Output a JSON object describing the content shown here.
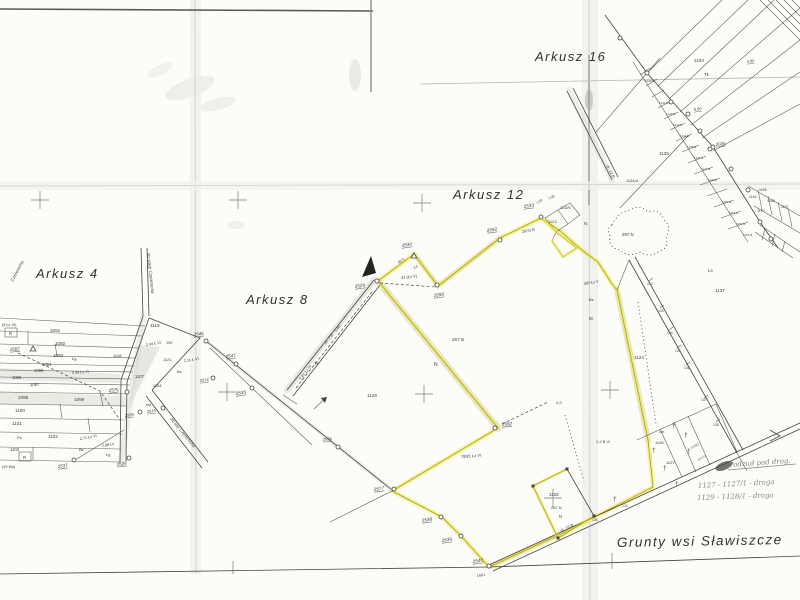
{
  "map_title": "Grunty wsi Sławiszcze",
  "colors": {
    "paper": "#fcfcf9",
    "ink": "#45453f",
    "pencil": "#87877f",
    "highlight": "#efe93e"
  },
  "handwritten_notes": {
    "heading": "Podział pod drog.",
    "line1": "1127 -  1127/1 -  droga",
    "line2": "1129 -  1128/1 -  droga"
  },
  "sheet_names": [
    "Arkusz 4",
    "Arkusz 8",
    "Arkusz 12",
    "Arkusz 16"
  ],
  "labels": [
    {
      "t": "Arkusz 4",
      "x": 36,
      "y": 278,
      "s": 13,
      "r": 0,
      "c": 1
    },
    {
      "t": "Arkusz 8",
      "x": 246,
      "y": 304,
      "s": 13,
      "r": 0,
      "c": 1
    },
    {
      "t": "Arkusz 12",
      "x": 453,
      "y": 199,
      "s": 13,
      "r": 0,
      "c": 1
    },
    {
      "t": "Arkusz 16",
      "x": 535,
      "y": 61,
      "s": 13,
      "r": 0,
      "c": 1
    },
    {
      "t": "Grunty  wsi  Sławiszcze",
      "x": 617,
      "y": 547,
      "s": 13.5,
      "r": -1,
      "c": 1
    },
    {
      "t": "Podział pod drog.",
      "x": 729,
      "y": 467,
      "s": 7,
      "r": -4,
      "c": 3
    },
    {
      "t": "1127 -   1127/1  -  droga",
      "x": 698,
      "y": 488,
      "s": 7,
      "r": -3,
      "c": 3
    },
    {
      "t": "1129 -   1128/1  -  droga",
      "x": 697,
      "y": 500,
      "s": 7,
      "r": -2,
      "c": 3
    },
    {
      "t": "2529",
      "x": 355,
      "y": 288,
      "s": 4.6,
      "r": -8,
      "c": 2
    },
    {
      "t": "2530",
      "x": 402,
      "y": 247,
      "s": 4.6,
      "r": -8,
      "c": 2
    },
    {
      "t": "2596",
      "x": 434,
      "y": 297,
      "s": 4.6,
      "r": -8,
      "c": 2
    },
    {
      "t": "2592",
      "x": 487,
      "y": 232,
      "s": 4.6,
      "r": -8,
      "c": 2
    },
    {
      "t": "2533",
      "x": 524,
      "y": 208,
      "s": 4.6,
      "r": -8,
      "c": 2
    },
    {
      "t": "2582",
      "x": 502,
      "y": 426,
      "s": 4.6,
      "r": -5,
      "c": 2
    },
    {
      "t": "2577",
      "x": 374,
      "y": 491,
      "s": 4.6,
      "r": -8,
      "c": 2
    },
    {
      "t": "2538",
      "x": 422,
      "y": 522,
      "s": 4.6,
      "r": -8,
      "c": 2
    },
    {
      "t": "2539",
      "x": 442,
      "y": 542,
      "s": 4.6,
      "r": -8,
      "c": 2
    },
    {
      "t": "2540",
      "x": 473,
      "y": 563,
      "s": 4.6,
      "r": -8,
      "c": 2
    },
    {
      "t": "1661",
      "x": 477,
      "y": 577,
      "s": 3.8,
      "r": -8,
      "c": 5
    },
    {
      "t": "2535",
      "x": 236,
      "y": 395,
      "s": 4.6,
      "r": -8,
      "c": 2
    },
    {
      "t": "2547",
      "x": 226,
      "y": 358,
      "s": 4.4,
      "r": -8,
      "c": 2
    },
    {
      "t": "2546",
      "x": 194,
      "y": 336,
      "s": 4.4,
      "r": -8,
      "c": 2
    },
    {
      "t": "2574",
      "x": 200,
      "y": 382,
      "s": 4,
      "r": -8,
      "c": 2
    },
    {
      "t": "2576",
      "x": 109,
      "y": 392,
      "s": 4.4,
      "r": -8,
      "c": 2
    },
    {
      "t": "2537",
      "x": 58,
      "y": 468,
      "s": 4.4,
      "r": -8,
      "c": 2
    },
    {
      "t": "2526",
      "x": 117,
      "y": 466,
      "s": 4.4,
      "r": -8,
      "c": 2
    },
    {
      "t": "2562",
      "x": 10,
      "y": 351,
      "s": 4.4,
      "r": -5,
      "c": 2
    },
    {
      "t": "2519",
      "x": 147,
      "y": 413,
      "s": 4,
      "r": -8,
      "c": 2
    },
    {
      "t": "2509",
      "x": 125,
      "y": 417,
      "s": 4,
      "r": -8,
      "c": 2
    },
    {
      "t": "2026",
      "x": 716,
      "y": 146,
      "s": 4.4,
      "r": -8,
      "c": 2
    },
    {
      "t": "0.90",
      "x": 694,
      "y": 111,
      "s": 4,
      "r": -8,
      "c": 2
    },
    {
      "t": "0.90",
      "x": 747,
      "y": 63,
      "s": 3.8,
      "r": -8,
      "c": 2
    },
    {
      "t": "2534",
      "x": 323,
      "y": 441,
      "s": 4,
      "r": -8,
      "c": 2
    },
    {
      "t": "1091",
      "x": 50,
      "y": 332,
      "s": 4.6,
      "r": 0,
      "c": 0
    },
    {
      "t": "1092",
      "x": 55,
      "y": 345,
      "s": 4.6,
      "r": 0,
      "c": 0
    },
    {
      "t": "1093",
      "x": 53,
      "y": 357,
      "s": 4.6,
      "r": 0,
      "c": 0
    },
    {
      "t": "1094",
      "x": 42,
      "y": 366,
      "s": 4.2,
      "r": 0,
      "c": 0
    },
    {
      "t": "1095",
      "x": 34,
      "y": 372,
      "s": 4.2,
      "r": 0,
      "c": 0
    },
    {
      "t": "1096",
      "x": 12,
      "y": 379,
      "s": 4.2,
      "r": 0,
      "c": 0
    },
    {
      "t": "1097",
      "x": 30,
      "y": 386,
      "s": 4.2,
      "r": 0,
      "c": 0
    },
    {
      "t": "1098",
      "x": 18,
      "y": 399,
      "s": 4.6,
      "r": 0,
      "c": 0
    },
    {
      "t": "1099",
      "x": 74,
      "y": 401,
      "s": 4.6,
      "r": 0,
      "c": 0
    },
    {
      "t": "1100",
      "x": 15,
      "y": 412,
      "s": 4.6,
      "r": 0,
      "c": 0
    },
    {
      "t": "1101",
      "x": 12,
      "y": 425,
      "s": 4.6,
      "r": 0,
      "c": 0
    },
    {
      "t": "1102",
      "x": 48,
      "y": 438,
      "s": 4.6,
      "r": 0,
      "c": 0
    },
    {
      "t": "1103",
      "x": 10,
      "y": 451,
      "s": 4.2,
      "r": 0,
      "c": 0
    },
    {
      "t": "R",
      "x": 9,
      "y": 335,
      "s": 4.2,
      "r": 0,
      "c": 0
    },
    {
      "t": "R",
      "x": 23,
      "y": 459,
      "s": 4.2,
      "r": 0,
      "c": 0
    },
    {
      "t": "(5 Łz VI)",
      "x": 2,
      "y": 326,
      "s": 3.8,
      "r": 0,
      "c": 0
    },
    {
      "t": "(39 Ws)",
      "x": 2,
      "y": 468,
      "s": 3.8,
      "r": 0,
      "c": 0
    },
    {
      "t": "Łg",
      "x": 72,
      "y": 360,
      "s": 4,
      "r": 0,
      "c": 0
    },
    {
      "t": "Łg",
      "x": 106,
      "y": 456,
      "s": 4,
      "r": 0,
      "c": 0
    },
    {
      "t": "Ps",
      "x": 17,
      "y": 439,
      "s": 4,
      "r": 0,
      "c": 0
    },
    {
      "t": "Bz",
      "x": 79,
      "y": 451,
      "s": 4,
      "r": 0,
      "c": 0
    },
    {
      "t": "2,38 Łz VI",
      "x": 72,
      "y": 374,
      "s": 3.8,
      "r": -4,
      "c": 0
    },
    {
      "t": "2,71 Łz VI",
      "x": 80,
      "y": 440,
      "s": 3.8,
      "r": -10,
      "c": 0
    },
    {
      "t": "2,98 Łz",
      "x": 102,
      "y": 447,
      "s": 3.8,
      "r": -10,
      "c": 0
    },
    {
      "t": "1118",
      "x": 113,
      "y": 357,
      "s": 4,
      "r": 0,
      "c": 0
    },
    {
      "t": "1119",
      "x": 150,
      "y": 327,
      "s": 4.6,
      "r": 0,
      "c": 0
    },
    {
      "t": "1107",
      "x": 135,
      "y": 378,
      "s": 4.2,
      "r": 0,
      "c": 0
    },
    {
      "t": "1121",
      "x": 163,
      "y": 361,
      "s": 4,
      "r": 0,
      "c": 0
    },
    {
      "t": "1104",
      "x": 153,
      "y": 387,
      "s": 4,
      "r": 0,
      "c": 0
    },
    {
      "t": "2,44 Ł VI",
      "x": 146,
      "y": 346,
      "s": 3.8,
      "r": -8,
      "c": 0
    },
    {
      "t": "190",
      "x": 166,
      "y": 344,
      "s": 3.8,
      "r": 0,
      "c": 0
    },
    {
      "t": "2,11 Ł VI",
      "x": 184,
      "y": 362,
      "s": 3.8,
      "r": -8,
      "c": 0
    },
    {
      "t": "Bz",
      "x": 177,
      "y": 373,
      "s": 4,
      "r": 0,
      "c": 0
    },
    {
      "t": "mp",
      "x": 146,
      "y": 406,
      "s": 3.8,
      "r": 0,
      "c": 0
    },
    {
      "t": "Czeremcha",
      "x": 13,
      "y": 282,
      "s": 4.5,
      "r": -62,
      "c": 4
    },
    {
      "t": "do stacji Czeremcha",
      "x": 147,
      "y": 253,
      "s": 4.5,
      "r": 84,
      "c": 4
    },
    {
      "t": "do wsi Czeremcha",
      "x": 170,
      "y": 419,
      "s": 4.5,
      "r": 51,
      "c": 4
    },
    {
      "t": "1129",
      "x": 367,
      "y": 397,
      "s": 4.6,
      "r": 0,
      "c": 0
    },
    {
      "t": "Tk",
      "x": 314,
      "y": 365,
      "s": 4.2,
      "r": 0,
      "c": 0
    },
    {
      "t": "dr. 7 B",
      "x": 326,
      "y": 344,
      "s": 4,
      "r": -51,
      "c": 4
    },
    {
      "t": "1,60",
      "x": 336,
      "y": 332,
      "s": 3.8,
      "r": -51,
      "c": 0
    },
    {
      "t": "2,81 Łz VI",
      "x": 301,
      "y": 380,
      "s": 3.8,
      "r": -51,
      "c": 0
    },
    {
      "t": "45 ł.",
      "x": 399,
      "y": 264,
      "s": 4,
      "r": -36,
      "c": 0
    },
    {
      "t": "Łz",
      "x": 415,
      "y": 269,
      "s": 4,
      "r": -36,
      "c": 0
    },
    {
      "t": "43 (Łz V)",
      "x": 401,
      "y": 279,
      "s": 4,
      "r": -6,
      "c": 0
    },
    {
      "t": "267 B",
      "x": 452,
      "y": 341,
      "s": 4.6,
      "r": 0,
      "c": 0
    },
    {
      "t": "N",
      "x": 434,
      "y": 366,
      "s": 5,
      "r": 0,
      "c": 0
    },
    {
      "t": "N",
      "x": 584,
      "y": 225,
      "s": 4.4,
      "r": 0,
      "c": 0
    },
    {
      "t": "M",
      "x": 589,
      "y": 320,
      "s": 4.4,
      "r": 0,
      "c": 0
    },
    {
      "t": "789/1 Łz VI",
      "x": 461,
      "y": 458,
      "s": 4,
      "r": -4,
      "c": 0
    },
    {
      "t": "4,9",
      "x": 556,
      "y": 404,
      "s": 4,
      "r": 0,
      "c": 0
    },
    {
      "t": "2,2 B VI",
      "x": 596,
      "y": 443,
      "s": 4,
      "r": 0,
      "c": 0
    },
    {
      "t": "1123",
      "x": 548,
      "y": 223,
      "s": 4,
      "r": 0,
      "c": 0
    },
    {
      "t": "1132/5",
      "x": 560,
      "y": 209,
      "s": 3.5,
      "r": 0,
      "c": 0
    },
    {
      "t": "1,59",
      "x": 537,
      "y": 204,
      "s": 3.4,
      "r": -30,
      "c": 0
    },
    {
      "t": "7,08",
      "x": 549,
      "y": 200,
      "s": 3.4,
      "r": -30,
      "c": 0
    },
    {
      "t": "297/2 B",
      "x": 522,
      "y": 233,
      "s": 3.8,
      "r": -10,
      "c": 0
    },
    {
      "t": "283 Łz V",
      "x": 584,
      "y": 285,
      "s": 3.8,
      "r": -10,
      "c": 0
    },
    {
      "t": "Bz",
      "x": 589,
      "y": 301,
      "s": 4,
      "r": 0,
      "c": 0
    },
    {
      "t": "297 N",
      "x": 622,
      "y": 236,
      "s": 4.4,
      "r": 0,
      "c": 0
    },
    {
      "t": "dr. 12 B",
      "x": 606,
      "y": 166,
      "s": 4,
      "r": 62,
      "c": 4
    },
    {
      "t": "1135",
      "x": 659,
      "y": 155,
      "s": 4.6,
      "r": 0,
      "c": 0
    },
    {
      "t": "1134/4",
      "x": 626,
      "y": 182,
      "s": 4,
      "r": 0,
      "c": 0
    },
    {
      "t": "1163",
      "x": 694,
      "y": 62,
      "s": 4.6,
      "r": 0,
      "c": 0
    },
    {
      "t": "Tk",
      "x": 704,
      "y": 76,
      "s": 4.4,
      "r": 0,
      "c": 0
    },
    {
      "t": "Ls",
      "x": 708,
      "y": 272,
      "s": 4.4,
      "r": 0,
      "c": 0
    },
    {
      "t": "1137",
      "x": 715,
      "y": 292,
      "s": 4.6,
      "r": 0,
      "c": 0
    },
    {
      "t": "1124",
      "x": 634,
      "y": 359,
      "s": 4.6,
      "r": 0,
      "c": 0
    },
    {
      "t": "1157",
      "x": 781,
      "y": 208,
      "s": 3.5,
      "r": 0,
      "c": 0
    },
    {
      "t": "1164",
      "x": 749,
      "y": 198,
      "s": 3.5,
      "r": 0,
      "c": 0
    },
    {
      "t": "1165",
      "x": 759,
      "y": 191,
      "s": 3.5,
      "r": 0,
      "c": 0
    },
    {
      "t": "1168",
      "x": 767,
      "y": 202,
      "s": 3.5,
      "r": 0,
      "c": 0
    },
    {
      "t": "1170",
      "x": 757,
      "y": 212,
      "s": 3.5,
      "r": 0,
      "c": 0
    },
    {
      "t": "1139 B",
      "x": 645,
      "y": 82,
      "s": 3,
      "r": 0,
      "c": 5
    },
    {
      "t": "1141 B",
      "x": 659,
      "y": 104,
      "s": 3,
      "r": 0,
      "c": 5
    },
    {
      "t": "1142 B",
      "x": 666,
      "y": 115,
      "s": 3,
      "r": 0,
      "c": 5
    },
    {
      "t": "1143 B",
      "x": 673,
      "y": 126,
      "s": 3,
      "r": 0,
      "c": 5
    },
    {
      "t": "1144 B",
      "x": 680,
      "y": 137,
      "s": 3,
      "r": 0,
      "c": 5
    },
    {
      "t": "1145 B",
      "x": 687,
      "y": 148,
      "s": 3,
      "r": 0,
      "c": 5
    },
    {
      "t": "1146 B",
      "x": 694,
      "y": 159,
      "s": 3,
      "r": 0,
      "c": 5
    },
    {
      "t": "1147 B",
      "x": 701,
      "y": 170,
      "s": 3,
      "r": 0,
      "c": 5
    },
    {
      "t": "1148 B",
      "x": 708,
      "y": 181,
      "s": 3,
      "r": 0,
      "c": 5
    },
    {
      "t": "1150 B",
      "x": 722,
      "y": 203,
      "s": 3,
      "r": 0,
      "c": 5
    },
    {
      "t": "1151 B",
      "x": 729,
      "y": 214,
      "s": 3,
      "r": 0,
      "c": 5
    },
    {
      "t": "1152 B",
      "x": 736,
      "y": 225,
      "s": 3,
      "r": 0,
      "c": 5
    },
    {
      "t": "1153 B",
      "x": 743,
      "y": 236,
      "s": 3,
      "r": 0,
      "c": 5
    },
    {
      "t": "132",
      "x": 647,
      "y": 285,
      "s": 3.4,
      "r": 0,
      "c": 5
    },
    {
      "t": "133",
      "x": 658,
      "y": 312,
      "s": 3.4,
      "r": 0,
      "c": 5
    },
    {
      "t": "134",
      "x": 667,
      "y": 334,
      "s": 3.4,
      "r": 0,
      "c": 5
    },
    {
      "t": "135",
      "x": 675,
      "y": 352,
      "s": 3.4,
      "r": 0,
      "c": 5
    },
    {
      "t": "136",
      "x": 684,
      "y": 369,
      "s": 3.4,
      "r": 0,
      "c": 5
    },
    {
      "t": "137",
      "x": 701,
      "y": 401,
      "s": 3.4,
      "r": 0,
      "c": 5
    },
    {
      "t": "138",
      "x": 713,
      "y": 426,
      "s": 3.4,
      "r": 0,
      "c": 5
    },
    {
      "t": "1125",
      "x": 549,
      "y": 496,
      "s": 4.5,
      "r": 0,
      "c": 0
    },
    {
      "t": "287 N",
      "x": 551,
      "y": 509,
      "s": 4,
      "r": 0,
      "c": 0
    },
    {
      "t": "N",
      "x": 559,
      "y": 518,
      "s": 4.2,
      "r": 0,
      "c": 0
    },
    {
      "t": "dr. 19 B",
      "x": 561,
      "y": 532,
      "s": 4,
      "r": -25,
      "c": 4
    },
    {
      "t": "106",
      "x": 592,
      "y": 521,
      "s": 3.4,
      "r": 0,
      "c": 5
    },
    {
      "t": "142",
      "x": 622,
      "y": 507,
      "s": 3.4,
      "r": 0,
      "c": 5
    },
    {
      "t": "cm",
      "x": 659,
      "y": 433,
      "s": 4,
      "r": 0,
      "c": 0
    },
    {
      "t": "1128",
      "x": 655,
      "y": 444,
      "s": 4,
      "r": 0,
      "c": 0
    },
    {
      "t": "1127",
      "x": 666,
      "y": 464,
      "s": 4,
      "r": 0,
      "c": 0
    },
    {
      "t": "1128/1",
      "x": 691,
      "y": 449,
      "s": 3.2,
      "r": -26,
      "c": 5
    },
    {
      "t": "1127/1",
      "x": 698,
      "y": 461,
      "s": 3.2,
      "r": -26,
      "c": 5
    }
  ],
  "points": {
    "circles": [
      [
        377,
        281
      ],
      [
        437,
        285
      ],
      [
        500,
        240
      ],
      [
        541,
        217
      ],
      [
        495,
        428
      ],
      [
        394,
        489
      ],
      [
        441,
        517
      ],
      [
        461,
        536
      ],
      [
        489,
        566
      ],
      [
        252,
        388
      ],
      [
        236,
        364
      ],
      [
        206,
        341
      ],
      [
        213,
        378
      ],
      [
        127,
        392
      ],
      [
        74,
        460
      ],
      [
        129,
        458
      ],
      [
        163,
        408
      ],
      [
        140,
        412
      ],
      [
        710,
        149
      ],
      [
        688,
        114
      ],
      [
        338,
        447
      ],
      [
        620,
        38
      ],
      [
        647,
        73
      ],
      [
        671,
        102
      ],
      [
        700,
        131
      ],
      [
        713,
        147
      ],
      [
        731,
        169
      ],
      [
        748,
        190
      ],
      [
        760,
        222
      ],
      [
        771,
        239
      ]
    ],
    "triangles": [
      [
        414,
        256
      ],
      [
        33,
        349
      ]
    ],
    "squares": [
      [
        533,
        486
      ],
      [
        567,
        469
      ],
      [
        594,
        516
      ],
      [
        558,
        538
      ]
    ]
  },
  "grid_crosses": [
    [
      40,
      200
    ],
    [
      238,
      200
    ],
    [
      422,
      203
    ],
    [
      227,
      392
    ],
    [
      424,
      394
    ],
    [
      610,
      390
    ],
    [
      553,
      498
    ]
  ],
  "cemetery_crosses": [
    [
      672,
      428
    ],
    [
      684,
      437
    ],
    [
      652,
      452
    ],
    [
      663,
      470
    ],
    [
      687,
      453
    ],
    [
      613,
      501
    ],
    [
      675,
      486
    ]
  ]
}
